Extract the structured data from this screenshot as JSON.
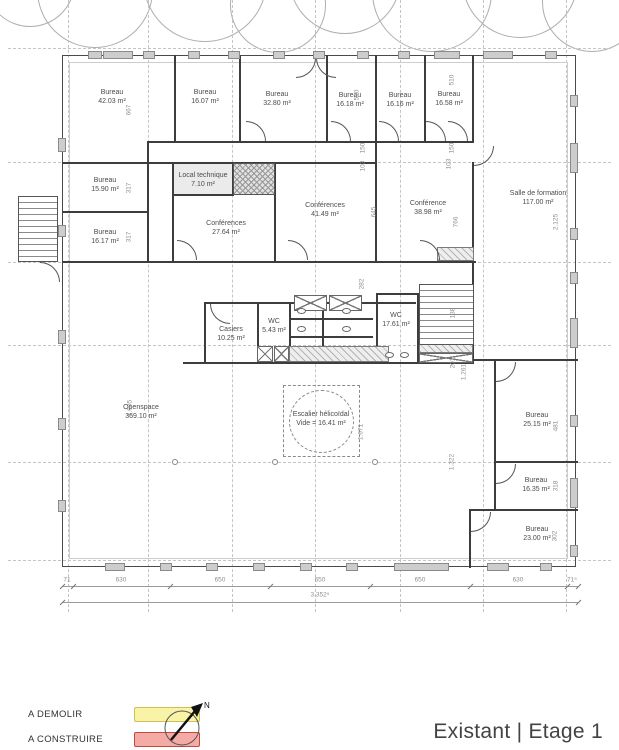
{
  "title": "Existant | Etage 1",
  "north": {
    "label": "N"
  },
  "legend": {
    "items": [
      {
        "label": "A DEMOLIR",
        "fill": "#f8f3a6",
        "stroke": "#cfc04f"
      },
      {
        "label": "A CONSTRUIRE",
        "fill": "#f4aba6",
        "stroke": "#c14a40"
      }
    ]
  },
  "plan": {
    "rooms": [
      {
        "name": "Bureau",
        "area": "42.03 m²",
        "cx": 112,
        "cy": 97
      },
      {
        "name": "Bureau",
        "area": "16.07 m²",
        "cx": 205,
        "cy": 97
      },
      {
        "name": "Bureau",
        "area": "32.80 m²",
        "cx": 277,
        "cy": 99
      },
      {
        "name": "Bureau",
        "area": "16.18 m²",
        "cx": 350,
        "cy": 100
      },
      {
        "name": "Bureau",
        "area": "16.16 m²",
        "cx": 400,
        "cy": 100
      },
      {
        "name": "Bureau",
        "area": "16.58 m²",
        "cx": 449,
        "cy": 99
      },
      {
        "name": "Bureau",
        "area": "15.90 m²",
        "cx": 105,
        "cy": 185
      },
      {
        "name": "Bureau",
        "area": "16.17 m²",
        "cx": 105,
        "cy": 237
      },
      {
        "name": "Local technique",
        "area": "7.10 m²",
        "cx": 203,
        "cy": 180
      },
      {
        "name": "Conférences",
        "area": "27.64 m²",
        "cx": 226,
        "cy": 228
      },
      {
        "name": "Conférences",
        "area": "41.49 m²",
        "cx": 325,
        "cy": 210
      },
      {
        "name": "Conférence",
        "area": "38.98 m²",
        "cx": 428,
        "cy": 208
      },
      {
        "name": "Salle de formation",
        "area": "117.00 m²",
        "cx": 538,
        "cy": 198
      },
      {
        "name": "Casiers",
        "area": "10.25 m²",
        "cx": 231,
        "cy": 334
      },
      {
        "name": "WC",
        "area": "5.43 m²",
        "cx": 274,
        "cy": 326
      },
      {
        "name": "WC",
        "area": "17.61 m²",
        "cx": 396,
        "cy": 320
      },
      {
        "name": "Escalier hélicoïdal",
        "area": "Vide = 16.41 m²",
        "cx": 321,
        "cy": 419
      },
      {
        "name": "Openspace",
        "area": "369.10 m²",
        "cx": 141,
        "cy": 412
      },
      {
        "name": "Bureau",
        "area": "25.15 m²",
        "cx": 537,
        "cy": 420
      },
      {
        "name": "Bureau",
        "area": "16.35 m²",
        "cx": 536,
        "cy": 485
      },
      {
        "name": "Bureau",
        "area": "23.00 m²",
        "cx": 537,
        "cy": 534
      }
    ],
    "dims_rot": [
      {
        "t": "667",
        "x": 129,
        "y": 110
      },
      {
        "t": "317",
        "x": 129,
        "y": 188
      },
      {
        "t": "317",
        "x": 129,
        "y": 237
      },
      {
        "t": "510",
        "x": 357,
        "y": 95
      },
      {
        "t": "510",
        "x": 452,
        "y": 80
      },
      {
        "t": "150",
        "x": 363,
        "y": 148
      },
      {
        "t": "103",
        "x": 363,
        "y": 166
      },
      {
        "t": "150",
        "x": 452,
        "y": 148
      },
      {
        "t": "103",
        "x": 449,
        "y": 164
      },
      {
        "t": "645",
        "x": 374,
        "y": 212
      },
      {
        "t": "766",
        "x": 456,
        "y": 222
      },
      {
        "t": "282",
        "x": 362,
        "y": 284
      },
      {
        "t": "2.125",
        "x": 556,
        "y": 222
      },
      {
        "t": "138",
        "x": 453,
        "y": 313
      },
      {
        "t": "201",
        "x": 453,
        "y": 363
      },
      {
        "t": "1.261",
        "x": 464,
        "y": 372
      },
      {
        "t": "1.905",
        "x": 130,
        "y": 408
      },
      {
        "t": "1.671",
        "x": 361,
        "y": 432
      },
      {
        "t": "1.322",
        "x": 452,
        "y": 462
      },
      {
        "t": "481",
        "x": 556,
        "y": 426
      },
      {
        "t": "318",
        "x": 556,
        "y": 486
      },
      {
        "t": "302",
        "x": 555,
        "y": 536
      }
    ],
    "dims_bottom": {
      "y": 584,
      "ticks": [
        62,
        73,
        170,
        270,
        370,
        470,
        567,
        578
      ],
      "labels": [
        {
          "t": "71",
          "x": 67
        },
        {
          "t": "630",
          "x": 121
        },
        {
          "t": "650",
          "x": 220
        },
        {
          "t": "650",
          "x": 320
        },
        {
          "t": "650",
          "x": 420
        },
        {
          "t": "630",
          "x": 518
        },
        {
          "t": "71⁵",
          "x": 572
        }
      ],
      "total": {
        "t": "3.352⁵",
        "x": 320,
        "y": 598
      }
    },
    "grid": {
      "verticals": [
        68,
        148,
        232,
        315,
        400,
        483,
        566
      ],
      "vspan": [
        0,
        612
      ],
      "horizontals": [
        48,
        162,
        262,
        345,
        462,
        560
      ],
      "hspan": [
        8,
        611
      ]
    },
    "trees": [
      {
        "cx": 30,
        "cy": -18,
        "r": 45
      },
      {
        "cx": 95,
        "cy": -10,
        "r": 58
      },
      {
        "cx": 205,
        "cy": -20,
        "r": 62
      },
      {
        "cx": 278,
        "cy": 5,
        "r": 48
      },
      {
        "cx": 345,
        "cy": -22,
        "r": 56
      },
      {
        "cx": 432,
        "cy": -8,
        "r": 60
      },
      {
        "cx": 520,
        "cy": -20,
        "r": 58
      },
      {
        "cx": 592,
        "cy": 2,
        "r": 50
      }
    ],
    "walls": [
      [
        174,
        55,
        2,
        87
      ],
      [
        239,
        55,
        2,
        87
      ],
      [
        326,
        55,
        2,
        87
      ],
      [
        375,
        55,
        2,
        87
      ],
      [
        424,
        55,
        2,
        87
      ],
      [
        472,
        55,
        2,
        88
      ],
      [
        148,
        141,
        326,
        2
      ],
      [
        62,
        162,
        88,
        2
      ],
      [
        147,
        141,
        2,
        122
      ],
      [
        62,
        211,
        86,
        2
      ],
      [
        62,
        261,
        414,
        2
      ],
      [
        148,
        162,
        228,
        2
      ],
      [
        172,
        162,
        2,
        100
      ],
      [
        172,
        194,
        62,
        2
      ],
      [
        232,
        162,
        2,
        34
      ],
      [
        274,
        162,
        2,
        100
      ],
      [
        375,
        141,
        2,
        122
      ],
      [
        472,
        162,
        2,
        201
      ],
      [
        474,
        359,
        104,
        2
      ],
      [
        494,
        461,
        84,
        2
      ],
      [
        469,
        509,
        109,
        2
      ],
      [
        494,
        359,
        2,
        152
      ],
      [
        469,
        509,
        2,
        59
      ],
      [
        204,
        302,
        212,
        2
      ],
      [
        204,
        302,
        2,
        62
      ],
      [
        257,
        302,
        2,
        62
      ],
      [
        289,
        302,
        2,
        62
      ],
      [
        322,
        302,
        2,
        61
      ],
      [
        183,
        362,
        291,
        2
      ],
      [
        376,
        293,
        2,
        71
      ],
      [
        417,
        293,
        2,
        71
      ],
      [
        376,
        293,
        43,
        2
      ],
      [
        289,
        318,
        84,
        2
      ],
      [
        289,
        336,
        84,
        2
      ],
      [
        37,
        200,
        2,
        58
      ]
    ],
    "roomfills": [
      [
        173,
        163,
        60,
        32
      ]
    ],
    "hatch": [
      [
        289,
        346,
        100,
        16
      ],
      [
        419,
        344,
        54,
        9
      ],
      [
        437,
        247,
        37,
        14
      ]
    ],
    "xhatch": [
      [
        233,
        163,
        42,
        32
      ]
    ],
    "xbox": [
      [
        294,
        295,
        33,
        16
      ],
      [
        329,
        295,
        33,
        16
      ],
      [
        257,
        346,
        16,
        16
      ],
      [
        274,
        346,
        15,
        16
      ],
      [
        419,
        353,
        54,
        10
      ]
    ],
    "treads": [
      [
        419,
        284,
        55,
        61
      ],
      [
        18,
        196,
        40,
        66
      ]
    ],
    "spiral": {
      "sq": [
        283,
        385,
        77,
        72
      ],
      "circ": [
        289,
        390,
        65,
        63
      ]
    },
    "ovals": [
      [
        297,
        308
      ],
      [
        297,
        326
      ],
      [
        342,
        308
      ],
      [
        342,
        326
      ],
      [
        385,
        352
      ],
      [
        400,
        352
      ]
    ],
    "dots": [
      [
        172,
        459
      ],
      [
        272,
        459
      ],
      [
        372,
        459
      ]
    ],
    "doors": [
      [
        246,
        121,
        90
      ],
      [
        331,
        121,
        90
      ],
      [
        379,
        121,
        90
      ],
      [
        426,
        121,
        90
      ],
      [
        448,
        121,
        90
      ],
      [
        177,
        240,
        90
      ],
      [
        288,
        240,
        90
      ],
      [
        420,
        240,
        90
      ],
      [
        496,
        362,
        180
      ],
      [
        496,
        464,
        180
      ],
      [
        471,
        512,
        180
      ],
      [
        474,
        146,
        180
      ],
      [
        210,
        304,
        270
      ],
      [
        40,
        262,
        90
      ],
      [
        296,
        58,
        180
      ],
      [
        316,
        58,
        270
      ]
    ],
    "columns": {
      "top": [
        [
          88,
          14
        ],
        [
          103,
          30
        ],
        [
          143,
          12
        ],
        [
          188,
          12
        ],
        [
          228,
          12
        ],
        [
          273,
          12
        ],
        [
          313,
          12
        ],
        [
          357,
          12
        ],
        [
          398,
          12
        ],
        [
          434,
          26
        ],
        [
          483,
          30
        ],
        [
          545,
          12
        ]
      ],
      "bottom": [
        [
          105,
          20
        ],
        [
          160,
          12
        ],
        [
          206,
          12
        ],
        [
          253,
          12
        ],
        [
          300,
          12
        ],
        [
          346,
          12
        ],
        [
          394,
          55
        ],
        [
          487,
          22
        ],
        [
          540,
          12
        ]
      ],
      "left": [
        [
          138,
          14
        ],
        [
          225,
          12
        ],
        [
          330,
          14
        ],
        [
          418,
          12
        ],
        [
          500,
          12
        ]
      ],
      "right": [
        [
          95,
          12
        ],
        [
          143,
          30
        ],
        [
          228,
          12
        ],
        [
          272,
          12
        ],
        [
          318,
          30
        ],
        [
          415,
          12
        ],
        [
          478,
          30
        ],
        [
          545,
          12
        ]
      ]
    }
  }
}
